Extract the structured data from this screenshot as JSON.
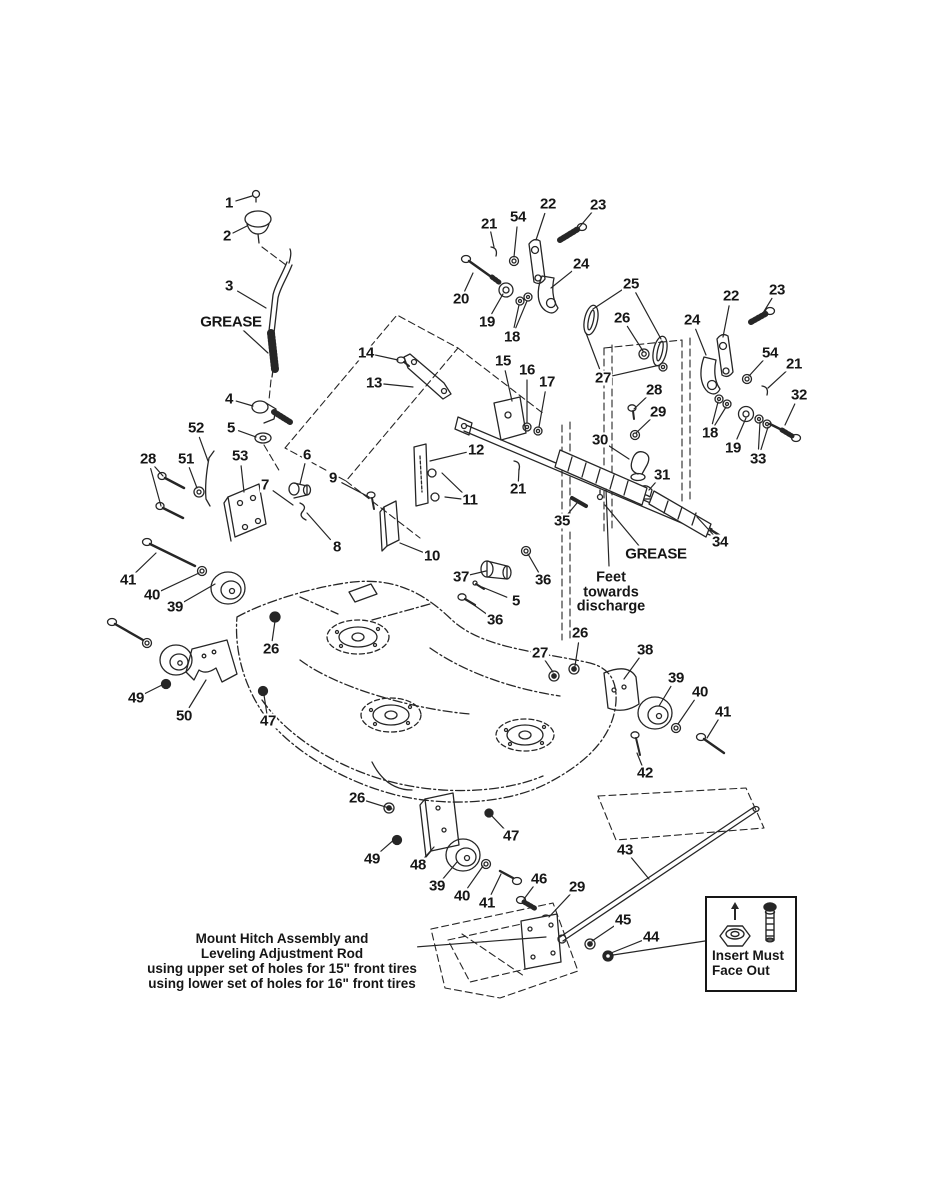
{
  "page": {
    "background": "#ffffff",
    "ink": "#262626"
  },
  "diagram": {
    "type": "exploded-parts-diagram",
    "subject": "Mower deck, gauge wheels and hitch linkage exploded view",
    "notes": {
      "grease_upper": {
        "text": "GREASE"
      },
      "grease_lower": {
        "text": "GREASE"
      },
      "feet_note": {
        "line1": "Feet",
        "line2": "towards",
        "line3": "discharge"
      },
      "mount_note": {
        "line1": "Mount Hitch Assembly and",
        "line2": "Leveling Adjustment Rod",
        "line3": "using upper set of holes for 15\" front tires",
        "line4": "using lower set of holes for 16\" front tires"
      },
      "insert_note": {
        "line1": "Insert Must",
        "line2": "Face Out"
      }
    },
    "part_labels": [
      {
        "text": "1",
        "x": 229,
        "y": 203,
        "targets": [
          [
            252,
            196
          ]
        ]
      },
      {
        "text": "2",
        "x": 227,
        "y": 236,
        "targets": [
          [
            247,
            226
          ]
        ]
      },
      {
        "text": "3",
        "x": 229,
        "y": 286,
        "targets": [
          [
            266,
            308
          ]
        ]
      },
      {
        "text": "4",
        "x": 229,
        "y": 399,
        "targets": [
          [
            253,
            406
          ]
        ]
      },
      {
        "text": "5",
        "x": 231,
        "y": 428,
        "targets": [
          [
            256,
            437
          ]
        ]
      },
      {
        "text": "52",
        "x": 196,
        "y": 428,
        "targets": [
          [
            208,
            461
          ]
        ]
      },
      {
        "text": "28",
        "x": 148,
        "y": 459,
        "targets": [
          [
            163,
            476
          ],
          [
            161,
            506
          ]
        ]
      },
      {
        "text": "51",
        "x": 186,
        "y": 459,
        "targets": [
          [
            197,
            488
          ]
        ]
      },
      {
        "text": "53",
        "x": 240,
        "y": 456,
        "targets": [
          [
            244,
            492
          ]
        ]
      },
      {
        "text": "6",
        "x": 307,
        "y": 455,
        "targets": [
          [
            300,
            484
          ]
        ]
      },
      {
        "text": "7",
        "x": 265,
        "y": 485,
        "targets": [
          [
            293,
            505
          ]
        ]
      },
      {
        "text": "9",
        "x": 333,
        "y": 478,
        "targets": [
          [
            369,
            497
          ]
        ]
      },
      {
        "text": "8",
        "x": 337,
        "y": 547,
        "targets": [
          [
            307,
            513
          ]
        ]
      },
      {
        "text": "10",
        "x": 432,
        "y": 556,
        "targets": [
          [
            400,
            543
          ]
        ]
      },
      {
        "text": "12",
        "x": 476,
        "y": 450,
        "targets": [
          [
            430,
            461
          ]
        ]
      },
      {
        "text": "11",
        "x": 470,
        "y": 500,
        "targets": [
          [
            442,
            473
          ],
          [
            445,
            497
          ]
        ]
      },
      {
        "text": "14",
        "x": 366,
        "y": 353,
        "targets": [
          [
            398,
            360
          ]
        ]
      },
      {
        "text": "13",
        "x": 374,
        "y": 383,
        "targets": [
          [
            413,
            387
          ]
        ]
      },
      {
        "text": "15",
        "x": 503,
        "y": 361,
        "targets": [
          [
            512,
            401
          ]
        ]
      },
      {
        "text": "16",
        "x": 527,
        "y": 370,
        "targets": [
          [
            527,
            423
          ]
        ]
      },
      {
        "text": "17",
        "x": 547,
        "y": 382,
        "targets": [
          [
            539,
            427
          ]
        ]
      },
      {
        "text": "20",
        "x": 461,
        "y": 299,
        "targets": [
          [
            473,
            273
          ]
        ]
      },
      {
        "text": "21",
        "x": 489,
        "y": 224,
        "targets": [
          [
            494,
            247
          ]
        ]
      },
      {
        "text": "54",
        "x": 518,
        "y": 217,
        "targets": [
          [
            514,
            257
          ]
        ]
      },
      {
        "text": "22",
        "x": 548,
        "y": 204,
        "targets": [
          [
            536,
            240
          ]
        ]
      },
      {
        "text": "23",
        "x": 598,
        "y": 205,
        "targets": [
          [
            577,
            230
          ]
        ]
      },
      {
        "text": "24",
        "x": 581,
        "y": 264,
        "targets": [
          [
            551,
            288
          ]
        ]
      },
      {
        "text": "19",
        "x": 487,
        "y": 322,
        "targets": [
          [
            503,
            294
          ]
        ]
      },
      {
        "text": "18",
        "x": 512,
        "y": 337,
        "targets": [
          [
            519,
            305
          ],
          [
            527,
            301
          ]
        ]
      },
      {
        "text": "25",
        "x": 631,
        "y": 284,
        "targets": [
          [
            593,
            309
          ],
          [
            661,
            339
          ]
        ]
      },
      {
        "text": "26",
        "x": 622,
        "y": 318,
        "targets": [
          [
            643,
            351
          ]
        ]
      },
      {
        "text": "27",
        "x": 603,
        "y": 378,
        "targets": [
          [
            586,
            333
          ],
          [
            660,
            365
          ]
        ]
      },
      {
        "text": "28",
        "x": 654,
        "y": 390,
        "targets": [
          [
            634,
            409
          ]
        ]
      },
      {
        "text": "29",
        "x": 658,
        "y": 412,
        "targets": [
          [
            636,
            433
          ]
        ]
      },
      {
        "text": "30",
        "x": 600,
        "y": 440,
        "targets": [
          [
            629,
            459
          ]
        ]
      },
      {
        "text": "31",
        "x": 662,
        "y": 475,
        "targets": [
          [
            649,
            490
          ]
        ]
      },
      {
        "text": "21",
        "x": 518,
        "y": 489,
        "targets": [
          [
            519,
            469
          ]
        ]
      },
      {
        "text": "35",
        "x": 562,
        "y": 521,
        "targets": [
          [
            577,
            503
          ]
        ]
      },
      {
        "text": "34",
        "x": 720,
        "y": 542,
        "targets": [
          [
            697,
            517
          ]
        ]
      },
      {
        "text": "22",
        "x": 731,
        "y": 296,
        "targets": [
          [
            723,
            337
          ]
        ]
      },
      {
        "text": "23",
        "x": 777,
        "y": 290,
        "targets": [
          [
            760,
            318
          ]
        ]
      },
      {
        "text": "24",
        "x": 692,
        "y": 320,
        "targets": [
          [
            706,
            355
          ]
        ]
      },
      {
        "text": "54",
        "x": 770,
        "y": 353,
        "targets": [
          [
            749,
            376
          ]
        ]
      },
      {
        "text": "21",
        "x": 794,
        "y": 364,
        "targets": [
          [
            768,
            388
          ]
        ]
      },
      {
        "text": "32",
        "x": 799,
        "y": 395,
        "targets": [
          [
            785,
            425
          ]
        ]
      },
      {
        "text": "18",
        "x": 710,
        "y": 433,
        "targets": [
          [
            718,
            402
          ],
          [
            726,
            407
          ]
        ]
      },
      {
        "text": "19",
        "x": 733,
        "y": 448,
        "targets": [
          [
            746,
            418
          ]
        ]
      },
      {
        "text": "33",
        "x": 758,
        "y": 459,
        "targets": [
          [
            760,
            422
          ],
          [
            768,
            427
          ]
        ]
      },
      {
        "text": "37",
        "x": 461,
        "y": 577,
        "targets": [
          [
            486,
            571
          ]
        ]
      },
      {
        "text": "36",
        "x": 543,
        "y": 580,
        "targets": [
          [
            528,
            554
          ]
        ]
      },
      {
        "text": "5",
        "x": 516,
        "y": 601,
        "targets": [
          [
            482,
            587
          ]
        ]
      },
      {
        "text": "36",
        "x": 495,
        "y": 620,
        "targets": [
          [
            467,
            600
          ]
        ]
      },
      {
        "text": "41",
        "x": 128,
        "y": 580,
        "targets": [
          [
            156,
            553
          ]
        ]
      },
      {
        "text": "40",
        "x": 152,
        "y": 595,
        "targets": [
          [
            199,
            573
          ]
        ]
      },
      {
        "text": "39",
        "x": 175,
        "y": 607,
        "targets": [
          [
            215,
            584
          ]
        ]
      },
      {
        "text": "26",
        "x": 271,
        "y": 649,
        "targets": [
          [
            275,
            621
          ]
        ]
      },
      {
        "text": "49",
        "x": 136,
        "y": 698,
        "targets": [
          [
            162,
            685
          ]
        ]
      },
      {
        "text": "50",
        "x": 184,
        "y": 716,
        "targets": [
          [
            206,
            680
          ]
        ]
      },
      {
        "text": "47",
        "x": 268,
        "y": 721,
        "targets": [
          [
            264,
            695
          ]
        ]
      },
      {
        "text": "26",
        "x": 580,
        "y": 633,
        "targets": [
          [
            575,
            666
          ]
        ]
      },
      {
        "text": "27",
        "x": 540,
        "y": 653,
        "targets": [
          [
            553,
            672
          ]
        ]
      },
      {
        "text": "38",
        "x": 645,
        "y": 650,
        "targets": [
          [
            624,
            679
          ]
        ]
      },
      {
        "text": "39",
        "x": 676,
        "y": 678,
        "targets": [
          [
            659,
            706
          ]
        ]
      },
      {
        "text": "40",
        "x": 700,
        "y": 692,
        "targets": [
          [
            678,
            724
          ]
        ]
      },
      {
        "text": "41",
        "x": 723,
        "y": 712,
        "targets": [
          [
            707,
            738
          ]
        ]
      },
      {
        "text": "42",
        "x": 645,
        "y": 773,
        "targets": [
          [
            637,
            753
          ]
        ]
      },
      {
        "text": "26",
        "x": 357,
        "y": 798,
        "targets": [
          [
            392,
            809
          ]
        ]
      },
      {
        "text": "49",
        "x": 372,
        "y": 859,
        "targets": [
          [
            396,
            838
          ]
        ]
      },
      {
        "text": "48",
        "x": 418,
        "y": 865,
        "targets": [
          [
            434,
            847
          ]
        ]
      },
      {
        "text": "39",
        "x": 437,
        "y": 886,
        "targets": [
          [
            457,
            862
          ]
        ]
      },
      {
        "text": "40",
        "x": 462,
        "y": 896,
        "targets": [
          [
            483,
            866
          ]
        ]
      },
      {
        "text": "41",
        "x": 487,
        "y": 903,
        "targets": [
          [
            501,
            874
          ]
        ]
      },
      {
        "text": "47",
        "x": 511,
        "y": 836,
        "targets": [
          [
            490,
            814
          ]
        ]
      },
      {
        "text": "46",
        "x": 539,
        "y": 879,
        "targets": [
          [
            524,
            899
          ]
        ]
      },
      {
        "text": "29",
        "x": 577,
        "y": 887,
        "targets": [
          [
            549,
            917
          ]
        ]
      },
      {
        "text": "43",
        "x": 625,
        "y": 850,
        "targets": [
          [
            649,
            879
          ]
        ]
      },
      {
        "text": "45",
        "x": 623,
        "y": 920,
        "targets": [
          [
            592,
            941
          ]
        ]
      },
      {
        "text": "44",
        "x": 651,
        "y": 937,
        "targets": [
          [
            611,
            953
          ]
        ]
      }
    ]
  }
}
